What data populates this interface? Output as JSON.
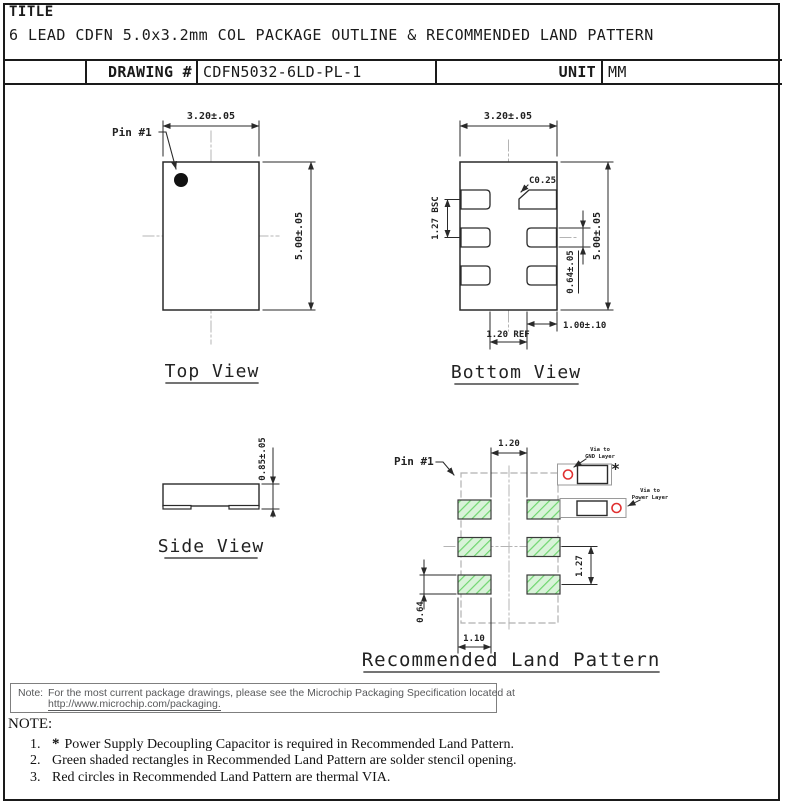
{
  "header": {
    "title_label": "TITLE",
    "title": "6 LEAD CDFN 5.0x3.2mm COL PACKAGE OUTLINE & RECOMMENDED LAND PATTERN",
    "drawing_label": "DRAWING #",
    "drawing_number": "CDFN5032-6LD-PL-1",
    "unit_label": "UNIT",
    "unit": "MM"
  },
  "top_view": {
    "label": "Top View",
    "pin1": "Pin #1",
    "dim_width": "3.20±.05",
    "dim_height": "5.00±.05"
  },
  "bottom_view": {
    "label": "Bottom View",
    "dim_width": "3.20±.05",
    "dim_height": "5.00±.05",
    "dim_pitch": "1.27 BSC",
    "dim_pad_width": "0.64±.05",
    "dim_pad_length": "1.00±.10",
    "dim_pad_gap": "1.20 REF",
    "dim_chamfer": "C0.25"
  },
  "side_view": {
    "label": "Side View",
    "dim_thickness": "0.85±.05"
  },
  "land_pattern": {
    "label": "Recommended Land Pattern",
    "pin1": "Pin #1",
    "dim_col_gap": "1.20",
    "dim_row_pitch": "1.27",
    "dim_pad_height": "0.64",
    "dim_pad_width": "1.10",
    "gnd_via_line1": "Via to",
    "gnd_via_line2": "GND Layer",
    "power_via_line1": "Via to",
    "power_via_line2": "Power Layer",
    "capacitor_marker": "*"
  },
  "package_note": {
    "label": "Note:",
    "line1": "For the most current package drawings, please see the Microchip Packaging Specification located at",
    "line2": "http://www.microchip.com/packaging."
  },
  "notes": {
    "heading": "NOTE:",
    "items": [
      {
        "num": "1.",
        "marker": "*",
        "text": "Power Supply Decoupling Capacitor is required in Recommended Land Pattern."
      },
      {
        "num": "2.",
        "text": "Green shaded rectangles in Recommended Land Pattern are solder stencil opening."
      },
      {
        "num": "3.",
        "text": "Red circles in Recommended Land Pattern are thermal VIA."
      }
    ]
  },
  "colors": {
    "stencil_fill": "#d9f3d9",
    "stencil_hatch": "#6fd66f",
    "via_red": "#e03030",
    "line": "#2a2a2a",
    "centerline": "#b4b4b4",
    "note_text": "#58595b"
  }
}
